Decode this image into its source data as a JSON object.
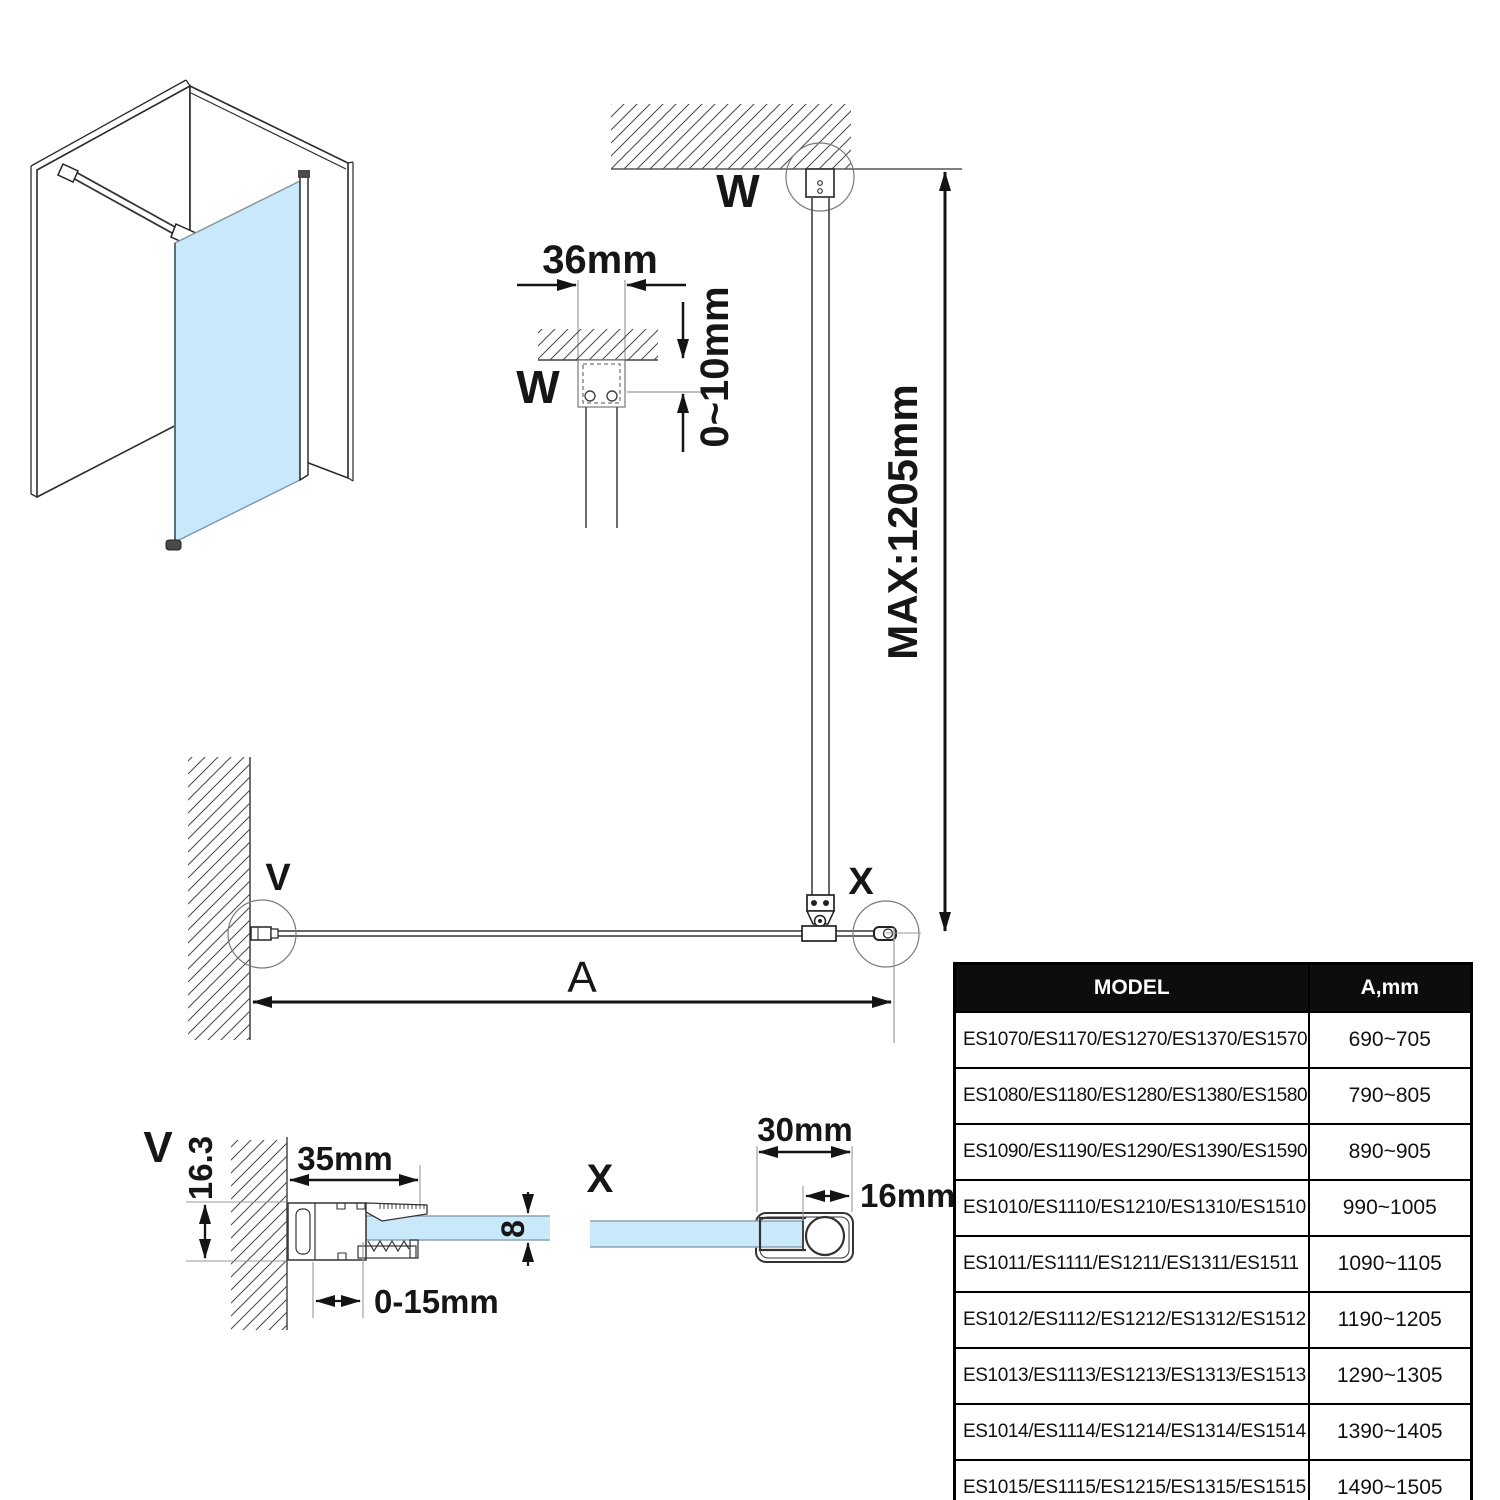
{
  "drawing": {
    "detail_w": {
      "label": "W",
      "width_dim": "36mm",
      "ceiling_gap_dim": "0~10mm"
    },
    "elevation": {
      "label": "W",
      "max_height_dim": "MAX:1205mm"
    },
    "plan": {
      "wall_label": "V",
      "end_label": "X",
      "width_label": "A"
    },
    "detail_v": {
      "label": "V",
      "wall_profile_height": "16.3",
      "profile_width": "35mm",
      "adjustment_range": "0-15mm",
      "glass_thickness": "8"
    },
    "detail_x": {
      "label": "X",
      "profile_width": "30mm",
      "profile_depth": "16mm"
    },
    "colors": {
      "glass": "#c9e8fa",
      "dim_line": "#141414",
      "construction_line": "#999999",
      "hatch_line": "#4a4a4a",
      "table_header_bg": "#0d0d0d"
    }
  },
  "table": {
    "headers": [
      "MODEL",
      "A,mm"
    ],
    "rows": [
      {
        "model": "ES1070/ES1170/ES1270/ES1370/ES1570",
        "a": "690~705"
      },
      {
        "model": "ES1080/ES1180/ES1280/ES1380/ES1580",
        "a": "790~805"
      },
      {
        "model": "ES1090/ES1190/ES1290/ES1390/ES1590",
        "a": "890~905"
      },
      {
        "model": "ES1010/ES1110/ES1210/ES1310/ES1510",
        "a": "990~1005"
      },
      {
        "model": "ES1011/ES1111/ES1211/ES1311/ES1511",
        "a": "1090~1105"
      },
      {
        "model": "ES1012/ES1112/ES1212/ES1312/ES1512",
        "a": "1190~1205"
      },
      {
        "model": "ES1013/ES1113/ES1213/ES1313/ES1513",
        "a": "1290~1305"
      },
      {
        "model": "ES1014/ES1114/ES1214/ES1314/ES1514",
        "a": "1390~1405"
      },
      {
        "model": "ES1015/ES1115/ES1215/ES1315/ES1515",
        "a": "1490~1505"
      }
    ]
  }
}
